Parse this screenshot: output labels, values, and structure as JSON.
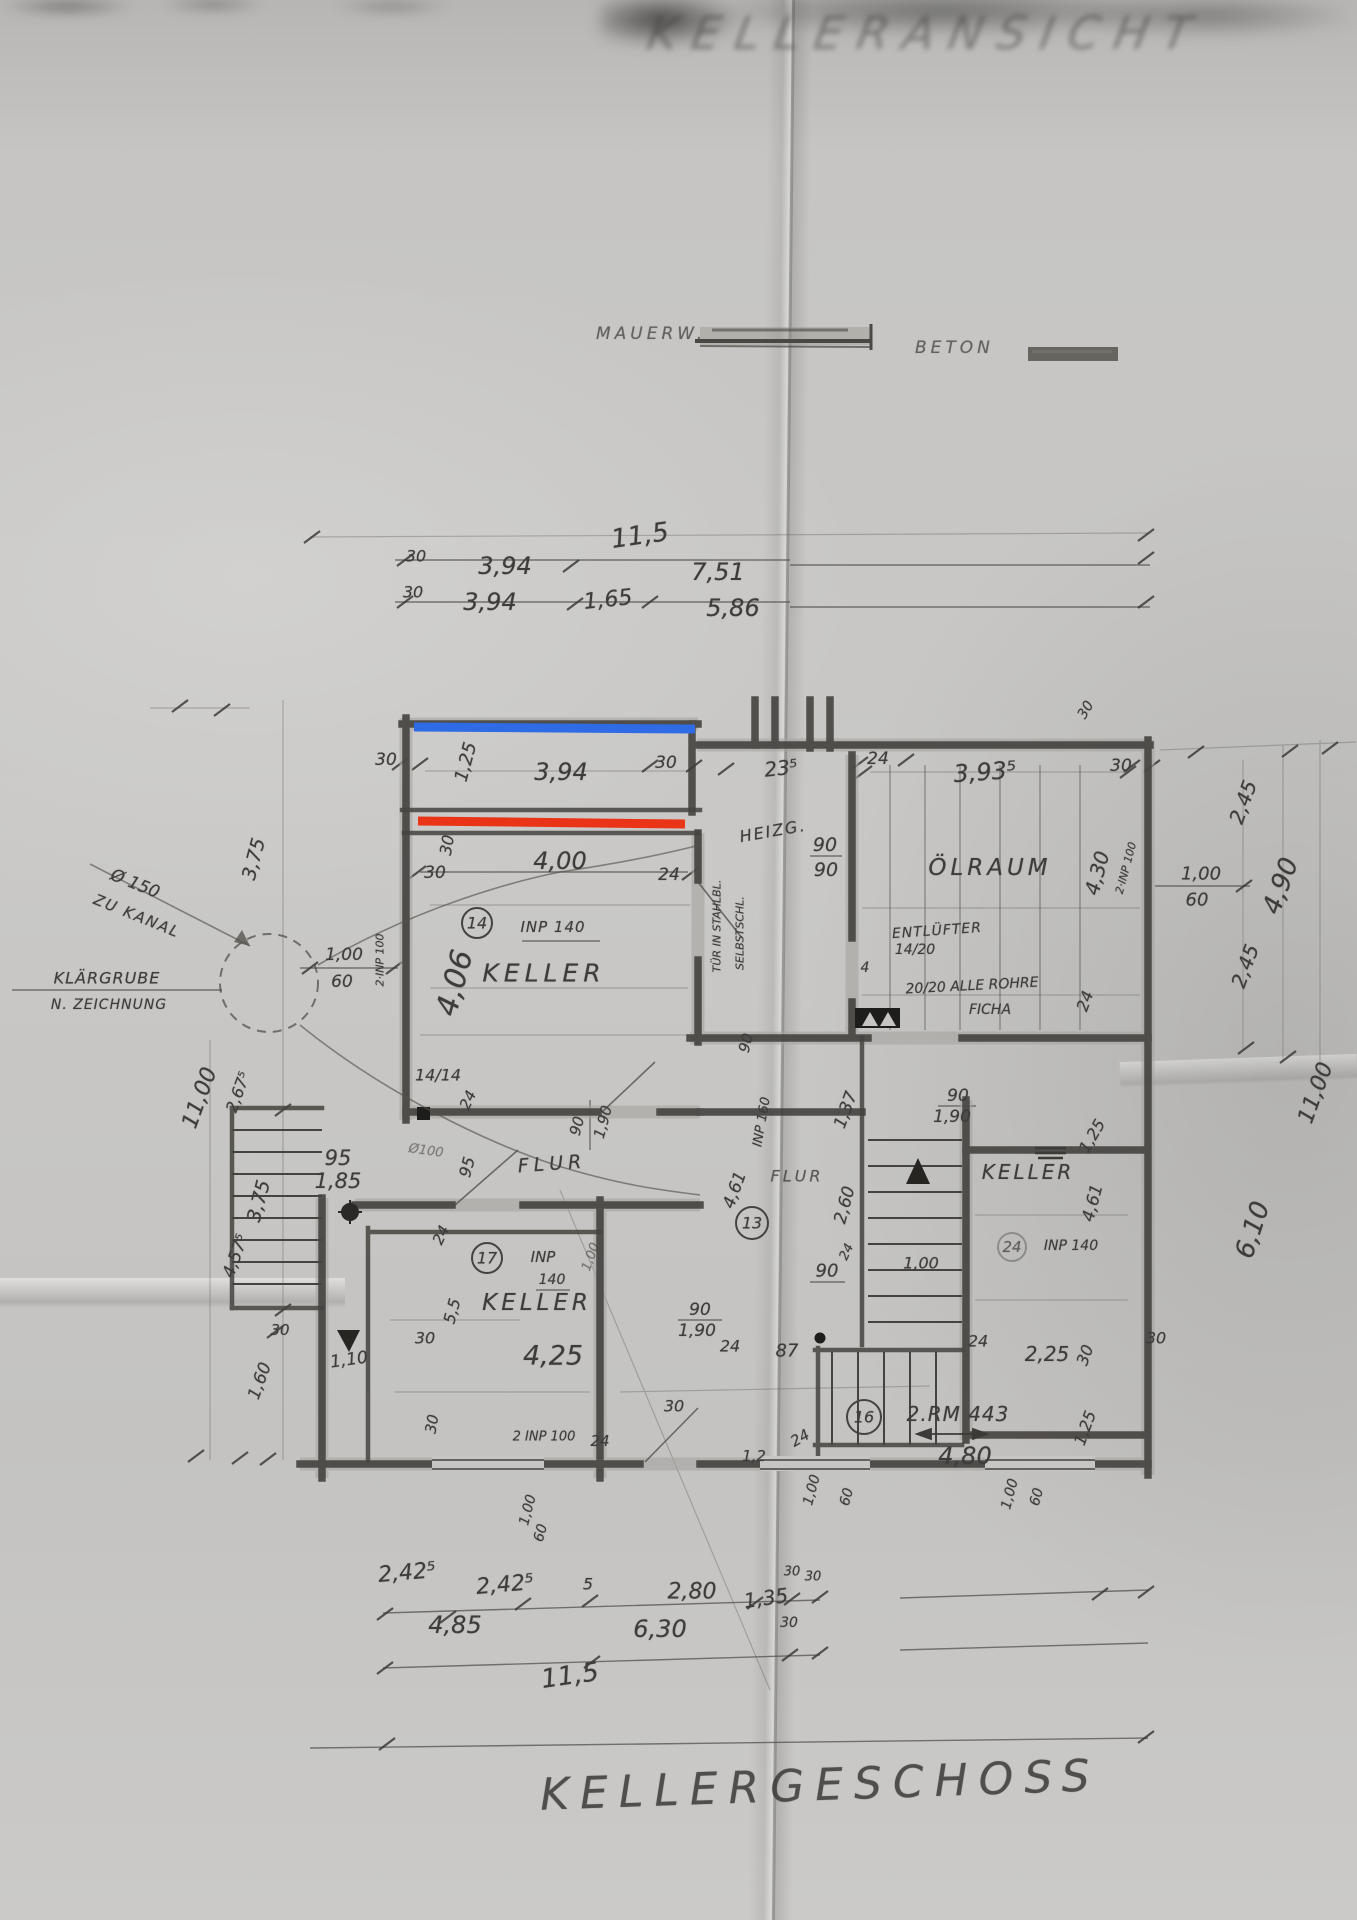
{
  "document": {
    "top_title": "KELLERANSICHT",
    "bottom_title": "KELLERGESCHOSS"
  },
  "legend": {
    "mauerwerk_label": "MAUERW.",
    "beton_label": "BETON"
  },
  "highlights": {
    "blue": {
      "color": "#2e6be4"
    },
    "red": {
      "color": "#ea3417"
    }
  },
  "paper": {
    "base_color": "#c6c5c3",
    "pencil_color": "#3d3c3a"
  },
  "plan": {
    "labels": [
      {
        "t": "11,5",
        "x": 640,
        "y": 536,
        "r": -8,
        "s": 26
      },
      {
        "t": "30",
        "x": 416,
        "y": 556,
        "s": 16
      },
      {
        "t": "3,94",
        "x": 505,
        "y": 566,
        "s": 24
      },
      {
        "t": "7,51",
        "x": 718,
        "y": 572,
        "s": 24
      },
      {
        "t": "30",
        "x": 413,
        "y": 592,
        "s": 16
      },
      {
        "t": "3,94",
        "x": 490,
        "y": 602,
        "s": 24
      },
      {
        "t": "1,65",
        "x": 608,
        "y": 600,
        "r": -6,
        "s": 22
      },
      {
        "t": "5,86",
        "x": 733,
        "y": 608,
        "s": 24
      },
      {
        "t": "30",
        "x": 386,
        "y": 760,
        "s": 17
      },
      {
        "t": "1,25",
        "x": 466,
        "y": 762,
        "r": -75,
        "s": 18
      },
      {
        "t": "3,94",
        "x": 561,
        "y": 772,
        "s": 24
      },
      {
        "t": "30",
        "x": 666,
        "y": 763,
        "s": 17
      },
      {
        "t": "23⁵",
        "x": 781,
        "y": 768,
        "r": -6,
        "s": 20
      },
      {
        "t": "24",
        "x": 878,
        "y": 759,
        "s": 17
      },
      {
        "t": "3,93⁵",
        "x": 985,
        "y": 772,
        "r": -4,
        "s": 24
      },
      {
        "t": "30",
        "x": 1121,
        "y": 766,
        "s": 17
      },
      {
        "t": "30",
        "x": 1086,
        "y": 710,
        "r": -60,
        "s": 14
      },
      {
        "t": "2,45",
        "x": 1243,
        "y": 802,
        "r": -70,
        "s": 20
      },
      {
        "t": "1,00",
        "x": 1201,
        "y": 874,
        "s": 18
      },
      {
        "t": "60",
        "x": 1197,
        "y": 900,
        "s": 18
      },
      {
        "t": "4,90",
        "x": 1281,
        "y": 886,
        "r": -70,
        "s": 26
      },
      {
        "t": "2,45",
        "x": 1245,
        "y": 966,
        "r": -70,
        "s": 20
      },
      {
        "t": "11,00",
        "x": 1316,
        "y": 1093,
        "r": -70,
        "s": 22
      },
      {
        "t": "4,30",
        "x": 1097,
        "y": 873,
        "r": -75,
        "s": 20
      },
      {
        "t": "2·INP 100",
        "x": 1126,
        "y": 868,
        "r": -75,
        "s": 11
      },
      {
        "t": "ÖLRAUM",
        "x": 990,
        "y": 868,
        "s": 23,
        "ls": 4,
        "n": "room-label-oelraum"
      },
      {
        "t": "HEIZG.",
        "x": 773,
        "y": 831,
        "r": -10,
        "s": 16,
        "ls": 2,
        "n": "room-label-heizung"
      },
      {
        "t": "90",
        "x": 825,
        "y": 845,
        "s": 19
      },
      {
        "t": "90",
        "x": 826,
        "y": 870,
        "s": 19
      },
      {
        "t": "ENTLÜFTER",
        "x": 937,
        "y": 931,
        "r": -4,
        "s": 14,
        "ls": 1,
        "n": "note-entlueftung"
      },
      {
        "t": "14/20",
        "x": 915,
        "y": 950,
        "s": 14
      },
      {
        "t": "20/20 ALLE ROHRE",
        "x": 972,
        "y": 986,
        "r": -3,
        "s": 14,
        "n": "note-rohre"
      },
      {
        "t": "FICHA",
        "x": 990,
        "y": 1010,
        "s": 14
      },
      {
        "t": "4",
        "x": 865,
        "y": 968,
        "s": 14
      },
      {
        "t": "24",
        "x": 1085,
        "y": 1001,
        "r": -70,
        "s": 16
      },
      {
        "t": "30",
        "x": 447,
        "y": 845,
        "r": -80,
        "s": 16
      },
      {
        "t": "4,00",
        "x": 560,
        "y": 861,
        "s": 24
      },
      {
        "t": "30",
        "x": 435,
        "y": 873,
        "s": 17
      },
      {
        "t": "24",
        "x": 669,
        "y": 875,
        "s": 17
      },
      {
        "t": "14",
        "x": 477,
        "y": 923,
        "s": 16,
        "n": "callout-14"
      },
      {
        "t": "INP 140",
        "x": 553,
        "y": 927,
        "s": 15,
        "ls": 1,
        "n": "beam-note-inp140"
      },
      {
        "t": "KELLER",
        "x": 544,
        "y": 973,
        "s": 25,
        "ls": 5,
        "n": "room-label-keller-1"
      },
      {
        "t": "4,06",
        "x": 455,
        "y": 983,
        "r": -75,
        "s": 30
      },
      {
        "t": "2·INP 100",
        "x": 380,
        "y": 960,
        "r": -90,
        "s": 11
      },
      {
        "t": "1,00",
        "x": 344,
        "y": 955,
        "s": 17
      },
      {
        "t": "60",
        "x": 342,
        "y": 982,
        "s": 17
      },
      {
        "t": "Ø 150",
        "x": 135,
        "y": 884,
        "r": 22,
        "s": 17,
        "n": "note-kanal-durchmesser"
      },
      {
        "t": "ZU KANAL",
        "x": 137,
        "y": 916,
        "r": 22,
        "s": 15,
        "ls": 2,
        "n": "note-zu-kanal"
      },
      {
        "t": "KLÄRGRUBE",
        "x": 107,
        "y": 978,
        "s": 16,
        "ls": 1,
        "n": "note-klaergrube"
      },
      {
        "t": "N. ZEICHNUNG",
        "x": 109,
        "y": 1005,
        "s": 14,
        "ls": 1,
        "n": "note-klaergrube-2"
      },
      {
        "t": "3,75",
        "x": 254,
        "y": 859,
        "r": -75,
        "s": 19
      },
      {
        "t": "11,00",
        "x": 200,
        "y": 1098,
        "r": -70,
        "s": 22
      },
      {
        "t": "2,67⁵",
        "x": 238,
        "y": 1092,
        "r": -70,
        "s": 16
      },
      {
        "t": "TÜR IN STAHLBL.",
        "x": 717,
        "y": 926,
        "r": -90,
        "s": 11,
        "n": "note-tuer-stahl"
      },
      {
        "t": "SELBSTSCHL.",
        "x": 740,
        "y": 933,
        "r": -90,
        "s": 11,
        "n": "note-selbstschliessend"
      },
      {
        "t": "90",
        "x": 746,
        "y": 1043,
        "r": -75,
        "s": 15
      },
      {
        "t": "14/14",
        "x": 438,
        "y": 1075,
        "s": 16
      },
      {
        "t": "24",
        "x": 468,
        "y": 1100,
        "r": -65,
        "s": 15
      },
      {
        "t": "95",
        "x": 338,
        "y": 1158,
        "s": 21
      },
      {
        "t": "1,85",
        "x": 338,
        "y": 1181,
        "s": 21
      },
      {
        "t": "Ø100",
        "x": 426,
        "y": 1151,
        "r": 8,
        "s": 13,
        "o": 0.55
      },
      {
        "t": "95",
        "x": 467,
        "y": 1167,
        "r": -75,
        "s": 16
      },
      {
        "t": "FLUR",
        "x": 552,
        "y": 1164,
        "r": -4,
        "s": 19,
        "ls": 5,
        "n": "room-label-flur-1"
      },
      {
        "t": "90",
        "x": 577,
        "y": 1126,
        "r": -75,
        "s": 15
      },
      {
        "t": "1,90",
        "x": 603,
        "y": 1122,
        "r": -75,
        "s": 15
      },
      {
        "t": "24",
        "x": 441,
        "y": 1235,
        "r": -65,
        "s": 15
      },
      {
        "t": "17",
        "x": 487,
        "y": 1258,
        "s": 16,
        "n": "callout-17"
      },
      {
        "t": "INP",
        "x": 543,
        "y": 1257,
        "s": 15
      },
      {
        "t": "140",
        "x": 552,
        "y": 1280,
        "s": 14
      },
      {
        "t": "1,00",
        "x": 591,
        "y": 1257,
        "r": -70,
        "s": 13,
        "o": 0.6
      },
      {
        "t": "INP 160",
        "x": 762,
        "y": 1122,
        "r": -80,
        "s": 13,
        "n": "beam-note-inp160"
      },
      {
        "t": "4,61",
        "x": 735,
        "y": 1190,
        "r": -70,
        "s": 17
      },
      {
        "t": "13",
        "x": 752,
        "y": 1223,
        "s": 16,
        "n": "callout-13"
      },
      {
        "t": "FLUR",
        "x": 797,
        "y": 1176,
        "s": 16,
        "ls": 3,
        "o": 0.8,
        "n": "room-label-flur-2"
      },
      {
        "t": "1,37",
        "x": 846,
        "y": 1110,
        "r": -70,
        "s": 17
      },
      {
        "t": "2,60",
        "x": 845,
        "y": 1205,
        "r": -75,
        "s": 17
      },
      {
        "t": "90",
        "x": 958,
        "y": 1096,
        "s": 17
      },
      {
        "t": "1,90",
        "x": 952,
        "y": 1117,
        "s": 17
      },
      {
        "t": "90",
        "x": 827,
        "y": 1271,
        "s": 18
      },
      {
        "t": "24",
        "x": 847,
        "y": 1252,
        "r": -65,
        "s": 13
      },
      {
        "t": "1,00",
        "x": 921,
        "y": 1263,
        "s": 16
      },
      {
        "t": "90",
        "x": 700,
        "y": 1310,
        "s": 17
      },
      {
        "t": "1,90",
        "x": 697,
        "y": 1331,
        "s": 17
      },
      {
        "t": "KELLER",
        "x": 1028,
        "y": 1172,
        "s": 20,
        "ls": 3,
        "n": "room-label-keller-3"
      },
      {
        "t": "4,61",
        "x": 1093,
        "y": 1203,
        "r": -75,
        "s": 17
      },
      {
        "t": "24",
        "x": 1012,
        "y": 1247,
        "s": 15,
        "o": 0.75
      },
      {
        "t": "INP 140",
        "x": 1071,
        "y": 1246,
        "s": 14
      },
      {
        "t": "1,25",
        "x": 1092,
        "y": 1136,
        "r": -60,
        "s": 16
      },
      {
        "t": "2,25",
        "x": 1047,
        "y": 1354,
        "s": 20
      },
      {
        "t": "30",
        "x": 1085,
        "y": 1355,
        "r": -70,
        "s": 16
      },
      {
        "t": "30",
        "x": 1156,
        "y": 1338,
        "s": 16
      },
      {
        "t": "6,10",
        "x": 1253,
        "y": 1230,
        "r": -72,
        "s": 26
      },
      {
        "t": "24",
        "x": 730,
        "y": 1346,
        "s": 16
      },
      {
        "t": "87",
        "x": 787,
        "y": 1351,
        "s": 18
      },
      {
        "t": "24",
        "x": 978,
        "y": 1341,
        "s": 16
      },
      {
        "t": "16",
        "x": 864,
        "y": 1417,
        "s": 16,
        "n": "callout-16"
      },
      {
        "t": "2.RM 443",
        "x": 958,
        "y": 1414,
        "s": 20,
        "ls": 1,
        "n": "beam-note-rm443"
      },
      {
        "t": "4,80",
        "x": 965,
        "y": 1456,
        "s": 24
      },
      {
        "t": "24",
        "x": 800,
        "y": 1438,
        "r": -30,
        "s": 15
      },
      {
        "t": "1,2",
        "x": 754,
        "y": 1456,
        "s": 15
      },
      {
        "t": "1,25",
        "x": 1085,
        "y": 1428,
        "r": -70,
        "s": 16
      },
      {
        "t": "1,00",
        "x": 812,
        "y": 1490,
        "r": -75,
        "s": 14
      },
      {
        "t": "60",
        "x": 847,
        "y": 1497,
        "r": -75,
        "s": 14
      },
      {
        "t": "1,00",
        "x": 1010,
        "y": 1494,
        "r": -75,
        "s": 14
      },
      {
        "t": "60",
        "x": 1037,
        "y": 1497,
        "r": -75,
        "s": 14
      },
      {
        "t": "1,00",
        "x": 528,
        "y": 1510,
        "r": -75,
        "s": 14
      },
      {
        "t": "60",
        "x": 541,
        "y": 1533,
        "r": -75,
        "s": 14
      },
      {
        "t": "KELLER",
        "x": 537,
        "y": 1303,
        "s": 23,
        "ls": 4,
        "n": "room-label-keller-2"
      },
      {
        "t": "5,5",
        "x": 452,
        "y": 1311,
        "r": -75,
        "s": 16
      },
      {
        "t": "30",
        "x": 425,
        "y": 1338,
        "s": 16
      },
      {
        "t": "4,25",
        "x": 553,
        "y": 1356,
        "s": 27
      },
      {
        "t": "1,10",
        "x": 349,
        "y": 1360,
        "r": -8,
        "s": 17
      },
      {
        "t": "30",
        "x": 432,
        "y": 1424,
        "r": -80,
        "s": 15
      },
      {
        "t": "2 INP 100",
        "x": 544,
        "y": 1437,
        "s": 13
      },
      {
        "t": "30",
        "x": 674,
        "y": 1406,
        "s": 16
      },
      {
        "t": "24",
        "x": 600,
        "y": 1441,
        "s": 15
      },
      {
        "t": "3,75",
        "x": 259,
        "y": 1201,
        "r": -75,
        "s": 19
      },
      {
        "t": "4,57⁵",
        "x": 236,
        "y": 1256,
        "r": -70,
        "s": 17
      },
      {
        "t": "30",
        "x": 280,
        "y": 1330,
        "s": 15
      },
      {
        "t": "1,60",
        "x": 260,
        "y": 1381,
        "r": -70,
        "s": 17
      },
      {
        "t": "2,42⁵",
        "x": 407,
        "y": 1573,
        "r": -5,
        "s": 22
      },
      {
        "t": "2,42⁵",
        "x": 505,
        "y": 1585,
        "r": -5,
        "s": 22
      },
      {
        "t": "5",
        "x": 588,
        "y": 1584,
        "s": 16
      },
      {
        "t": "2,80",
        "x": 692,
        "y": 1592,
        "s": 22
      },
      {
        "t": "1,35",
        "x": 766,
        "y": 1598,
        "r": -8,
        "s": 20
      },
      {
        "t": "30",
        "x": 792,
        "y": 1572,
        "s": 13
      },
      {
        "t": "30",
        "x": 813,
        "y": 1577,
        "s": 13
      },
      {
        "t": "4,85",
        "x": 455,
        "y": 1625,
        "s": 24
      },
      {
        "t": "6,30",
        "x": 660,
        "y": 1629,
        "s": 24
      },
      {
        "t": "30",
        "x": 789,
        "y": 1623,
        "s": 14
      },
      {
        "t": "11,5",
        "x": 570,
        "y": 1676,
        "r": -8,
        "s": 26
      }
    ]
  }
}
